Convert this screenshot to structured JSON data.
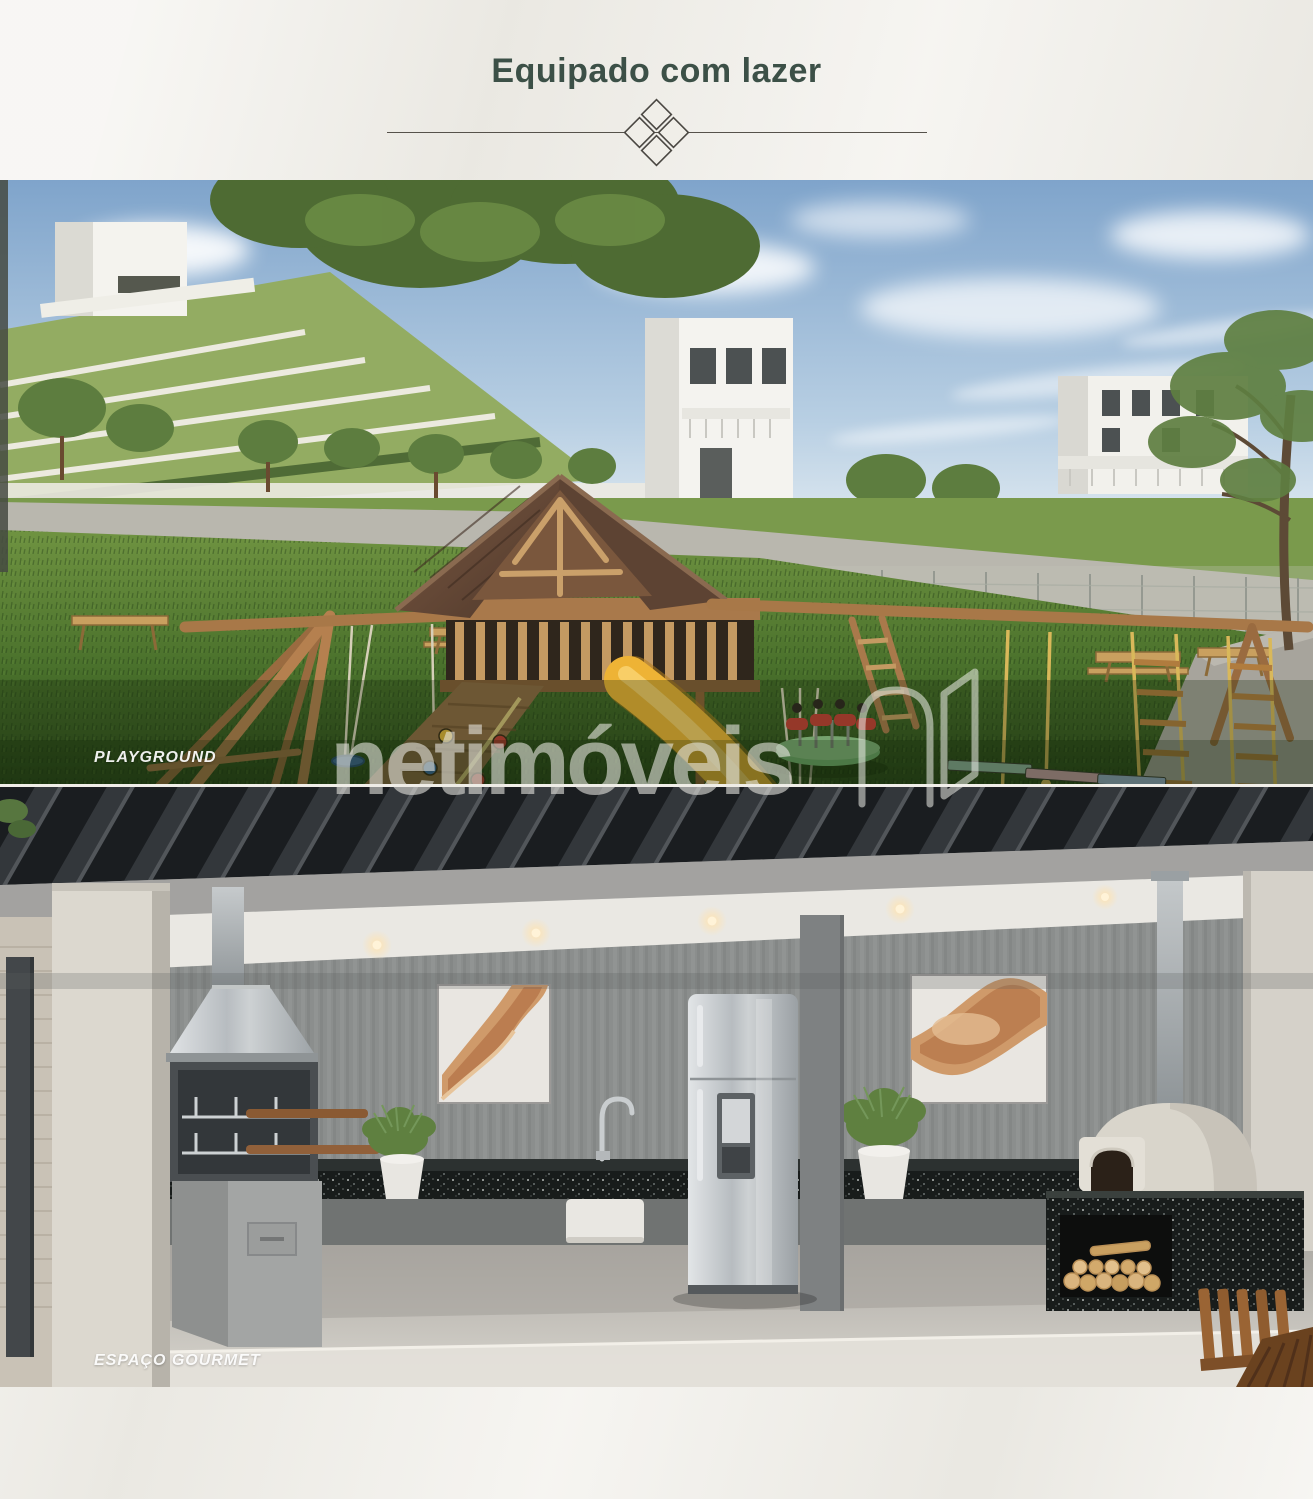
{
  "header": {
    "title": "Equipado com lazer",
    "title_color": "#3c5047"
  },
  "figures": [
    {
      "name": "playground",
      "label": "PLAYGROUND"
    },
    {
      "name": "espaco-gourmet",
      "label": "ESPAÇO GOURMET"
    }
  ],
  "watermark": {
    "text": "netimóveis",
    "logo_icon": "netimoveis-n-icon",
    "color": "#ecebE6"
  }
}
